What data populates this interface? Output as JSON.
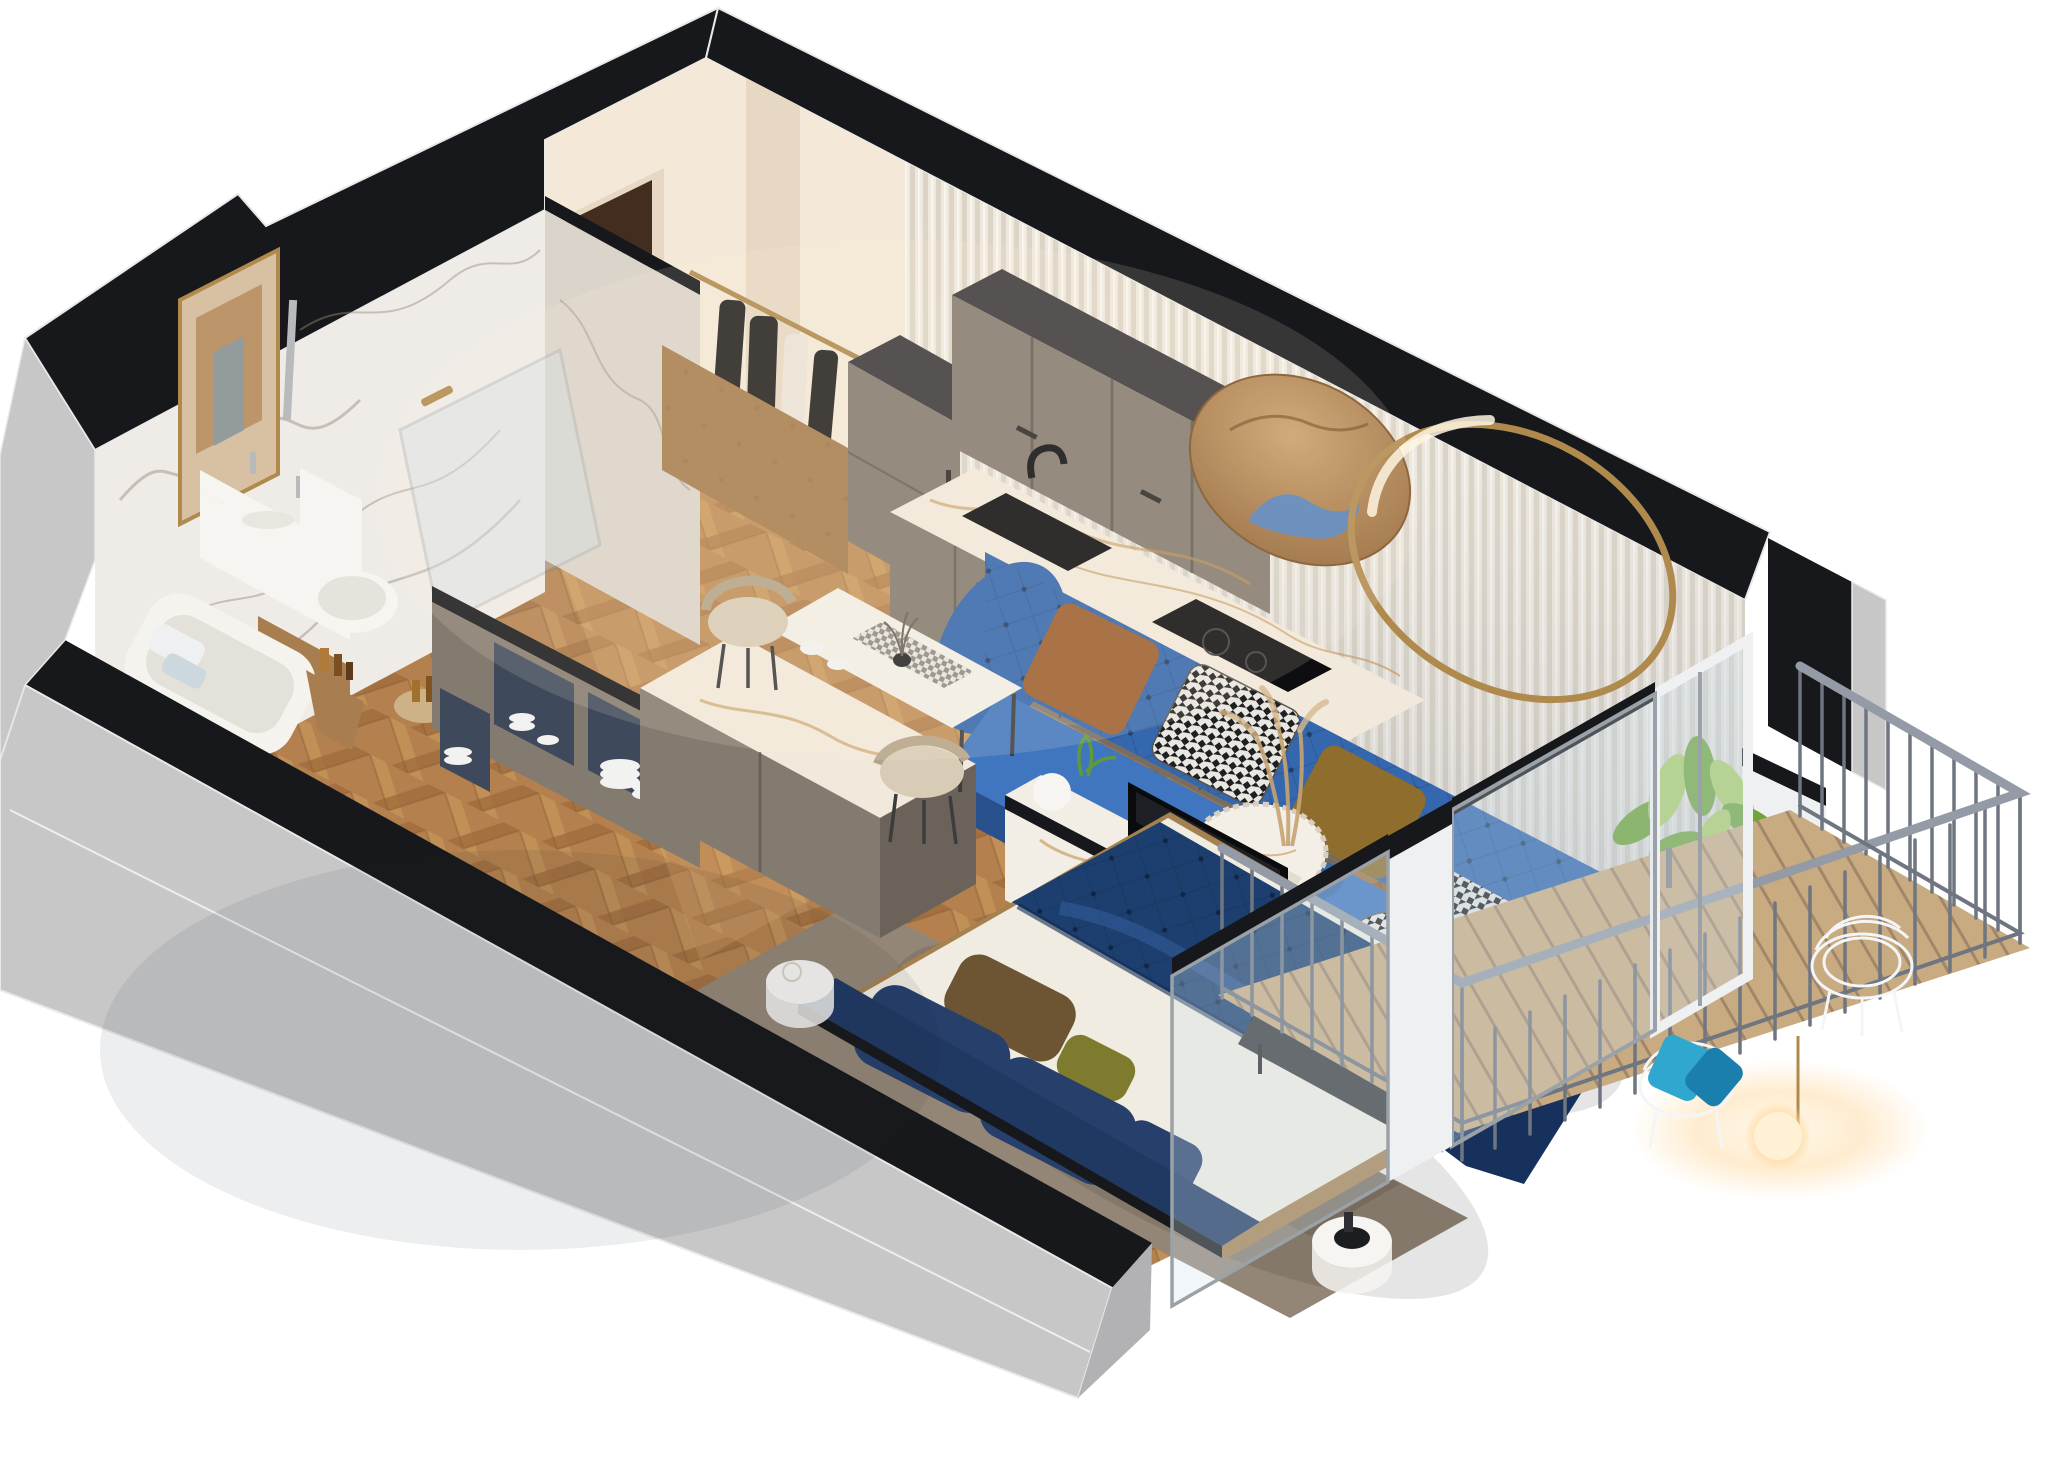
{
  "scene": {
    "title": "3D isometric cutaway floor plan of a studio apartment",
    "view": "axonometric bird's-eye cutaway, walls sectioned with black caps, light gray outer shell",
    "rooms": [
      {
        "name": "bathroom",
        "items": [
          "white marble walls",
          "gold framed mirror",
          "white vanity with twin faucets and wood drawer",
          "toilet",
          "bathtub with towels",
          "glass shower screen",
          "wooden stool with toiletries",
          "gray terrazzo floor",
          "chrome shower column"
        ]
      },
      {
        "name": "entry-hall",
        "items": [
          "dark brown entry door with brass handle",
          "open wardrobe with brass rail and hanging clothes",
          "herringbone parquet floor"
        ]
      },
      {
        "name": "kitchen",
        "items": [
          "taupe shaker cabinet run",
          "tall cabinet",
          "upper wall cabinets with black top",
          "white-and-gold marble worktop",
          "black undermount sink",
          "black faucet",
          "black induction cooktop",
          "built-in stainless oven",
          "white fluted slat feature wall"
        ]
      },
      {
        "name": "living-area",
        "items": [
          "blue tufted chesterfield sofa",
          "rust velvet pillow",
          "houndstooth pillow",
          "gold velvet pillow",
          "houndstooth throw",
          "round bronze wall mirror",
          "brass ring light",
          "mottled gray rug",
          "round marble coffee table on log base",
          "houndstooth pouf",
          "potted aglaonema plant",
          "white marble TV console with books",
          "flat-screen TV facing the bed"
        ]
      },
      {
        "name": "dining-area",
        "items": [
          "gray island with marble top",
          "white marble dining table",
          "checkered runner with tableware",
          "two beige shell dining chairs",
          "open gray shelving with navy interiors and stacked white dishes"
        ]
      },
      {
        "name": "sleeping-area",
        "items": [
          "double bed with tan base",
          "navy tufted velvet duvet",
          "white sheets",
          "navy velvet pillows",
          "brown and olive pillows",
          "navy headboard",
          "charcoal foot bench",
          "two round white bedside tables"
        ]
      },
      {
        "name": "balcony",
        "items": [
          "wood plank deck",
          "steel vertical-bar railing",
          "two white wire chairs",
          "teal pillows",
          "glowing sphere floor lamp",
          "white framed glass balcony door",
          "floor-to-ceiling windows"
        ]
      }
    ]
  },
  "colors": {
    "band": "#17181b",
    "outerWall": "#c7c7c8",
    "outerWallDark": "#b2b2b4",
    "cream": "#f4e9d8",
    "creamShade": "#e6d8c3",
    "flute": "#efe8dc",
    "fluteShade": "#c9c1b2",
    "marble": "#efece7",
    "marbleShade": "#dbd4cb",
    "vein": "#96897d",
    "terrazzo": "#b3aca4",
    "woodFloor": "#b4814e",
    "woodDark": "#8a5c33",
    "woodLight": "#c9996300",
    "deck": "#c9ab82",
    "deckGap": "#a1866a",
    "cabinet": "#847b70",
    "cabinetDark": "#6b6359",
    "cabinetTop": "#3a393b",
    "counterMarble": "#f1e9db",
    "counterVein": "#c19252",
    "black": "#0e0e10",
    "steel": "#b9babc",
    "wardrobeWood": "#a87e50",
    "clothesDark": "#232220",
    "clothesLight": "#e9e4d8",
    "doorBrown": "#432d1f",
    "brassGold": "#b08a4d",
    "mirrorBronzeA": "#caa06b",
    "mirrorBronzeB": "#8e5f31",
    "reflectBlue": "#4f82c4",
    "sofaMain": "#3467ae",
    "sofaDark": "#27508c",
    "sofaSeat": "#4076bf",
    "sofaSheen": "#9cc0e8",
    "pillowRust": "#9c5e2f",
    "pillowGold": "#8f6d2c",
    "houndsA": "#e9e7e2",
    "houndsB": "#1f1f1f",
    "rug": "#948677",
    "rugDark": "#7a6d5f",
    "tableWhite": "#f3efe7",
    "logWood": "#7c5d3a",
    "consoleWhite": "#f2eee6",
    "tvBlack": "#0a0b0d",
    "duvet": "#1d3f70",
    "duvetHi": "#35629f",
    "sheet": "#f1ece1",
    "headboard": "#203962",
    "bedFrame": "#a5814f",
    "pillowNavy": "#263f6b",
    "pillowBrown": "#6d5433",
    "pillowOlive": "#7f7b2e",
    "benchDark": "#3a3a3c",
    "glass": "#cfe0ea",
    "frameWhite": "#eef0f2",
    "frameSilver": "#9aa2a8",
    "railing": "#6f7681",
    "railLight": "#949ba6",
    "wireChair": "#f3f5f7",
    "teal": "#2fa7cf",
    "tealDark": "#1b7fae",
    "lampGlow": "#ffd9a0",
    "leafA": "#6fa33c",
    "leafB": "#a9cc68",
    "potBrown": "#8a6746",
    "chairBeige": "#d9ccb6",
    "chairBeigeDark": "#b3a489",
    "shelfNavy": "#3e4a5c",
    "dish": "#f2f2f0"
  }
}
